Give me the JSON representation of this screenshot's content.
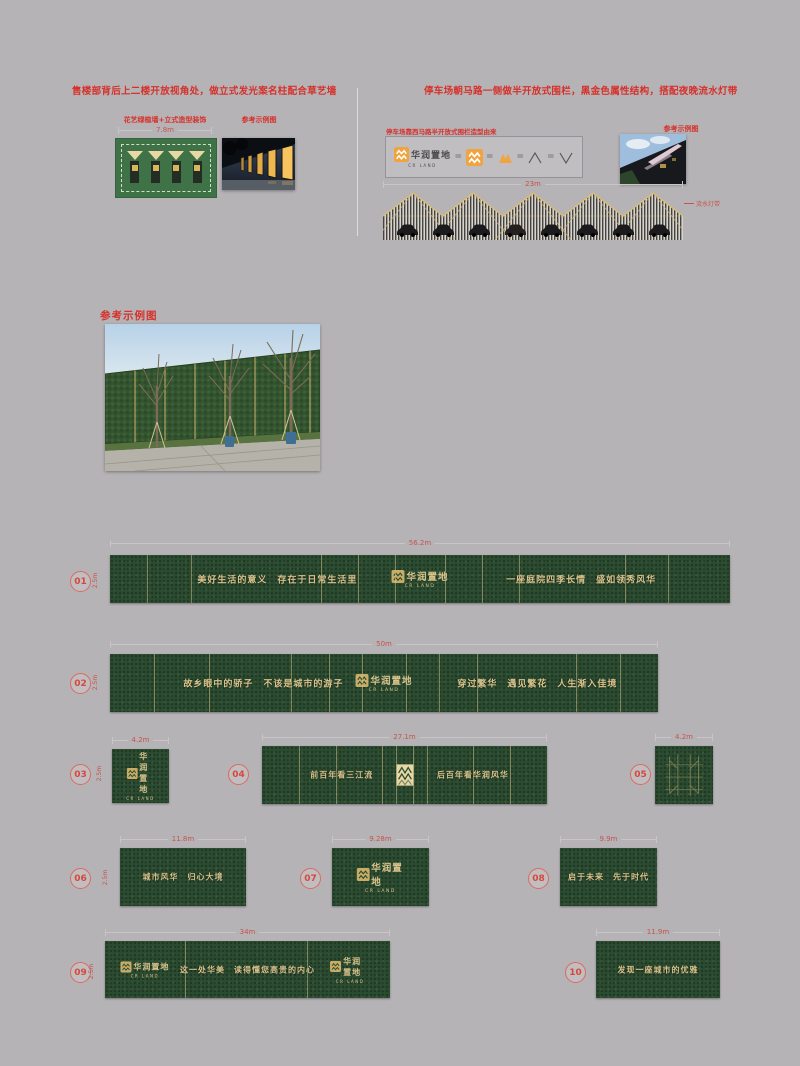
{
  "colors": {
    "background": "#b6b3b6",
    "accent_red": "#d6312b",
    "panel_green": "#2b4c31",
    "gold_text": "#d8c38b",
    "logo_orange": "#f0a43f"
  },
  "header": {
    "left": {
      "title": "售楼部背后上二楼开放视角处，做立式发光案名柱配合草艺墙",
      "diagram_caption": "花艺绿植墙+立式造型装饰",
      "diagram_width": "7.8m",
      "photo_caption": "参考示例图"
    },
    "right": {
      "title": "停车场朝马路一侧做半开放式围栏，黑金色属性结构，搭配夜晚流水灯带",
      "derivation_caption": "停车场靠西马路半开放式围栏造型由来",
      "photo_caption": "参考示例图",
      "fence_width": "23m",
      "fence_note": "流水灯带",
      "equals": "="
    }
  },
  "reference": {
    "title": "参考示例图"
  },
  "logo": {
    "cn": "华润置地",
    "en": "CR LAND"
  },
  "walls": {
    "height_label": "2.5m",
    "items": [
      {
        "num": "01",
        "width": "56.2m",
        "left_text": "美好生活的意义　存在于日常生活里",
        "right_text": "一座庭院四季长情　盛如领秀风华"
      },
      {
        "num": "02",
        "width": "50m",
        "left_text": "故乡眼中的骄子　不该是城市的游子",
        "right_text": "穿过繁华　遇见繁花　人生渐入佳境"
      },
      {
        "num": "03",
        "width": "4.2m"
      },
      {
        "num": "04",
        "width": "27.1m",
        "left_text": "前百年看三江流",
        "right_text": "后百年看华润风华"
      },
      {
        "num": "05",
        "width": "4.2m"
      },
      {
        "num": "06",
        "width": "11.8m",
        "text": "城市风华　归心大境"
      },
      {
        "num": "07",
        "width": "9.28m"
      },
      {
        "num": "08",
        "width": "9.9m",
        "text": "启于未来　先于时代"
      },
      {
        "num": "09",
        "width": "34m",
        "text": "这一处华美　读得懂您高贵的内心"
      },
      {
        "num": "10",
        "width": "11.9m",
        "text": "发现一座城市的优雅"
      }
    ]
  }
}
